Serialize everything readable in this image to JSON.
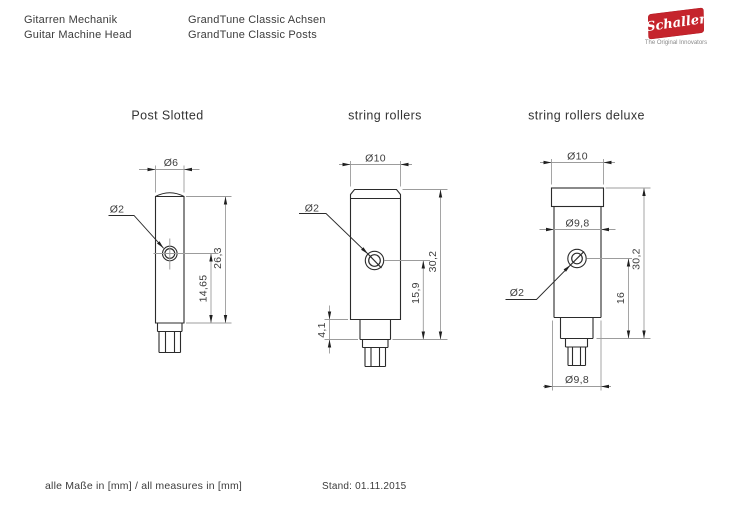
{
  "header": {
    "title_de": "Gitarren Mechanik",
    "title_en": "Guitar Machine Head",
    "product_de": "GrandTune Classic Achsen",
    "product_en": "GrandTune Classic Posts"
  },
  "logo": {
    "brand": "Schaller",
    "tagline": "The Original Innovators",
    "brand_color": "#c5242c"
  },
  "drawings": [
    {
      "title": "Post Slotted",
      "dims": {
        "top_diameter": "Ø6",
        "hole_diameter": "Ø2",
        "total_height": "26,3",
        "hole_center_height": "14,65"
      }
    },
    {
      "title": "string rollers",
      "dims": {
        "top_diameter": "Ø10",
        "hole_diameter": "Ø2",
        "total_height": "30,2",
        "hole_center_height": "15,9",
        "step_height": "4,1"
      }
    },
    {
      "title": "string rollers deluxe",
      "dims": {
        "top_diameter": "Ø10",
        "roller_diameter_top": "Ø9,8",
        "hole_diameter": "Ø2",
        "total_height": "30,2",
        "hole_center_height": "16",
        "roller_diameter_bottom": "Ø9,8"
      }
    }
  ],
  "footer": {
    "units_note": "alle Maße in [mm] / all measures in [mm]",
    "revision": "Stand: 01.11.2015"
  }
}
